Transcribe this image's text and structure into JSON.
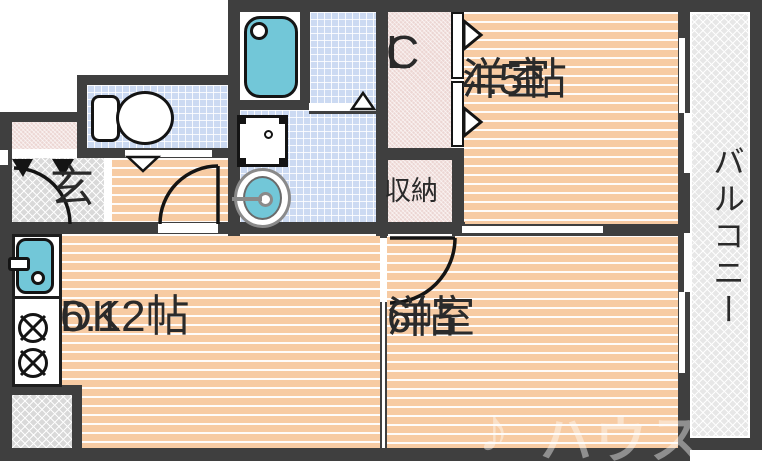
{
  "floorplan": {
    "type": "apartment-floor-plan",
    "rooms": {
      "western45": {
        "name": "洋室",
        "size": "4.5帖"
      },
      "western6": {
        "name": "洋室",
        "size": "6帖"
      },
      "dk": {
        "name": "DK",
        "size": "6.12帖"
      },
      "closet": {
        "letters": [
          "C",
          "L"
        ]
      },
      "storage": {
        "label": "収納"
      },
      "entrance": {
        "label": "玄"
      },
      "balcony": {
        "label": "バルコニー"
      }
    },
    "fixtures": [
      "bathtub",
      "washing-machine-pan",
      "wash-basin",
      "toilet",
      "kitchen-sink",
      "gas-stove-2-burner"
    ],
    "watermark": {
      "logo": "♪",
      "text": "ハウス"
    },
    "colors": {
      "wall": "#3f3f3f",
      "room_floor": "#f7cba3",
      "tile_floor": "#ccdaf2",
      "closet_floor": "#ecd6d3",
      "concrete_floor": "#d9d9d9",
      "balcony_floor": "#e7e7e7",
      "fixture_teal": "#72c7d8"
    }
  }
}
